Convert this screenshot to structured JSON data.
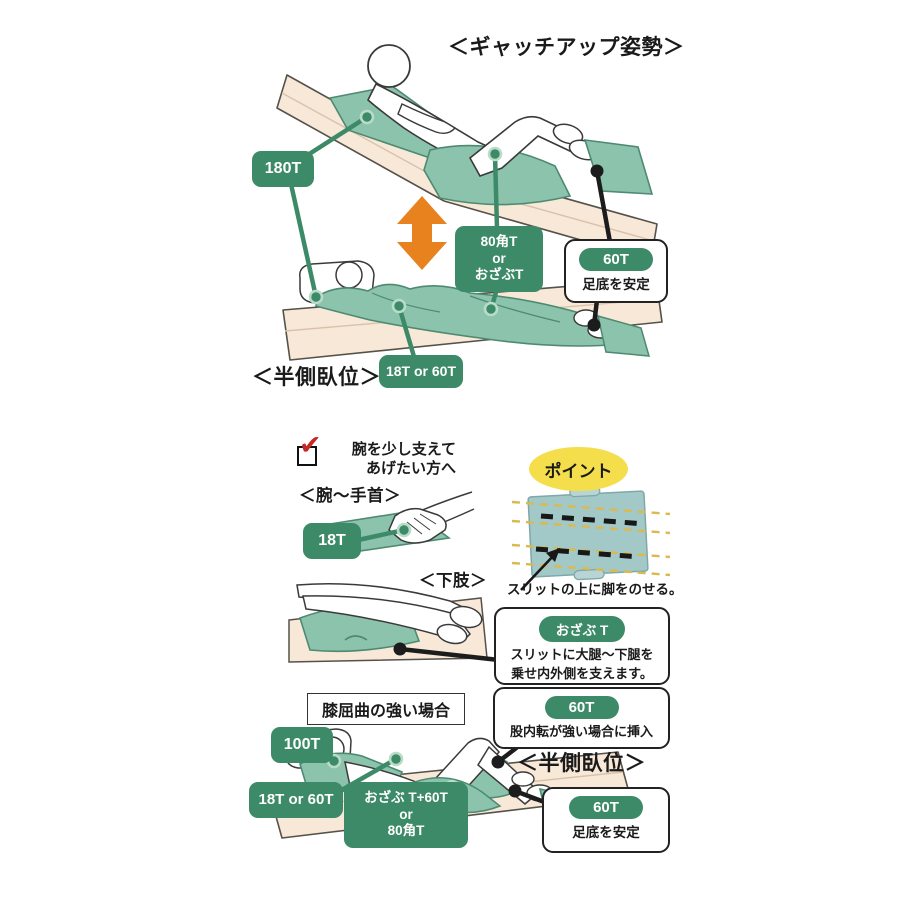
{
  "colors": {
    "label_green": "#3d8a68",
    "cushion_teal": "#8cc3ad",
    "cushion_teal_dark": "#4e8a72",
    "bed_peach": "#f8e8d8",
    "arrow_orange": "#e8821e",
    "point_yellow": "#f4de4c",
    "pad_teal": "#a3c8c8",
    "check_red": "#c62828"
  },
  "top": {
    "title": "＜ギャッチアップ姿勢＞",
    "label_back": "180T",
    "label_knee": "80角T\nor\nおざぶT",
    "foot_box": {
      "badge": "60T",
      "note": "足底を安定"
    },
    "caption_side": "＜半側臥位＞",
    "label_arm": "18T or 60T"
  },
  "middle": {
    "check_note": "腕を少し支えて\nあげたい方へ",
    "checkmark_glyph": "✔",
    "caption_wrist": "＜腕～手首＞",
    "label_wrist": "18T",
    "point_badge": "ポイント",
    "point_note": "スリットの上に脚をのせる。",
    "caption_leg": "＜下肢＞",
    "leg_box": {
      "badge": "おざぶ T",
      "note": "スリットに大腿～下腿を\n乗せ内外側を支えます。"
    }
  },
  "bottom": {
    "case_title": "膝屈曲の強い場合",
    "label_head": "100T",
    "adduction_box": {
      "badge": "60T",
      "note": "股内転が強い場合に挿入"
    },
    "caption_side": "＜半側臥位＞",
    "label_shoulder": "18T or 60T",
    "label_combo": "おざぶ T+60T\nor\n80角T",
    "foot_box": {
      "badge": "60T",
      "note": "足底を安定"
    }
  }
}
